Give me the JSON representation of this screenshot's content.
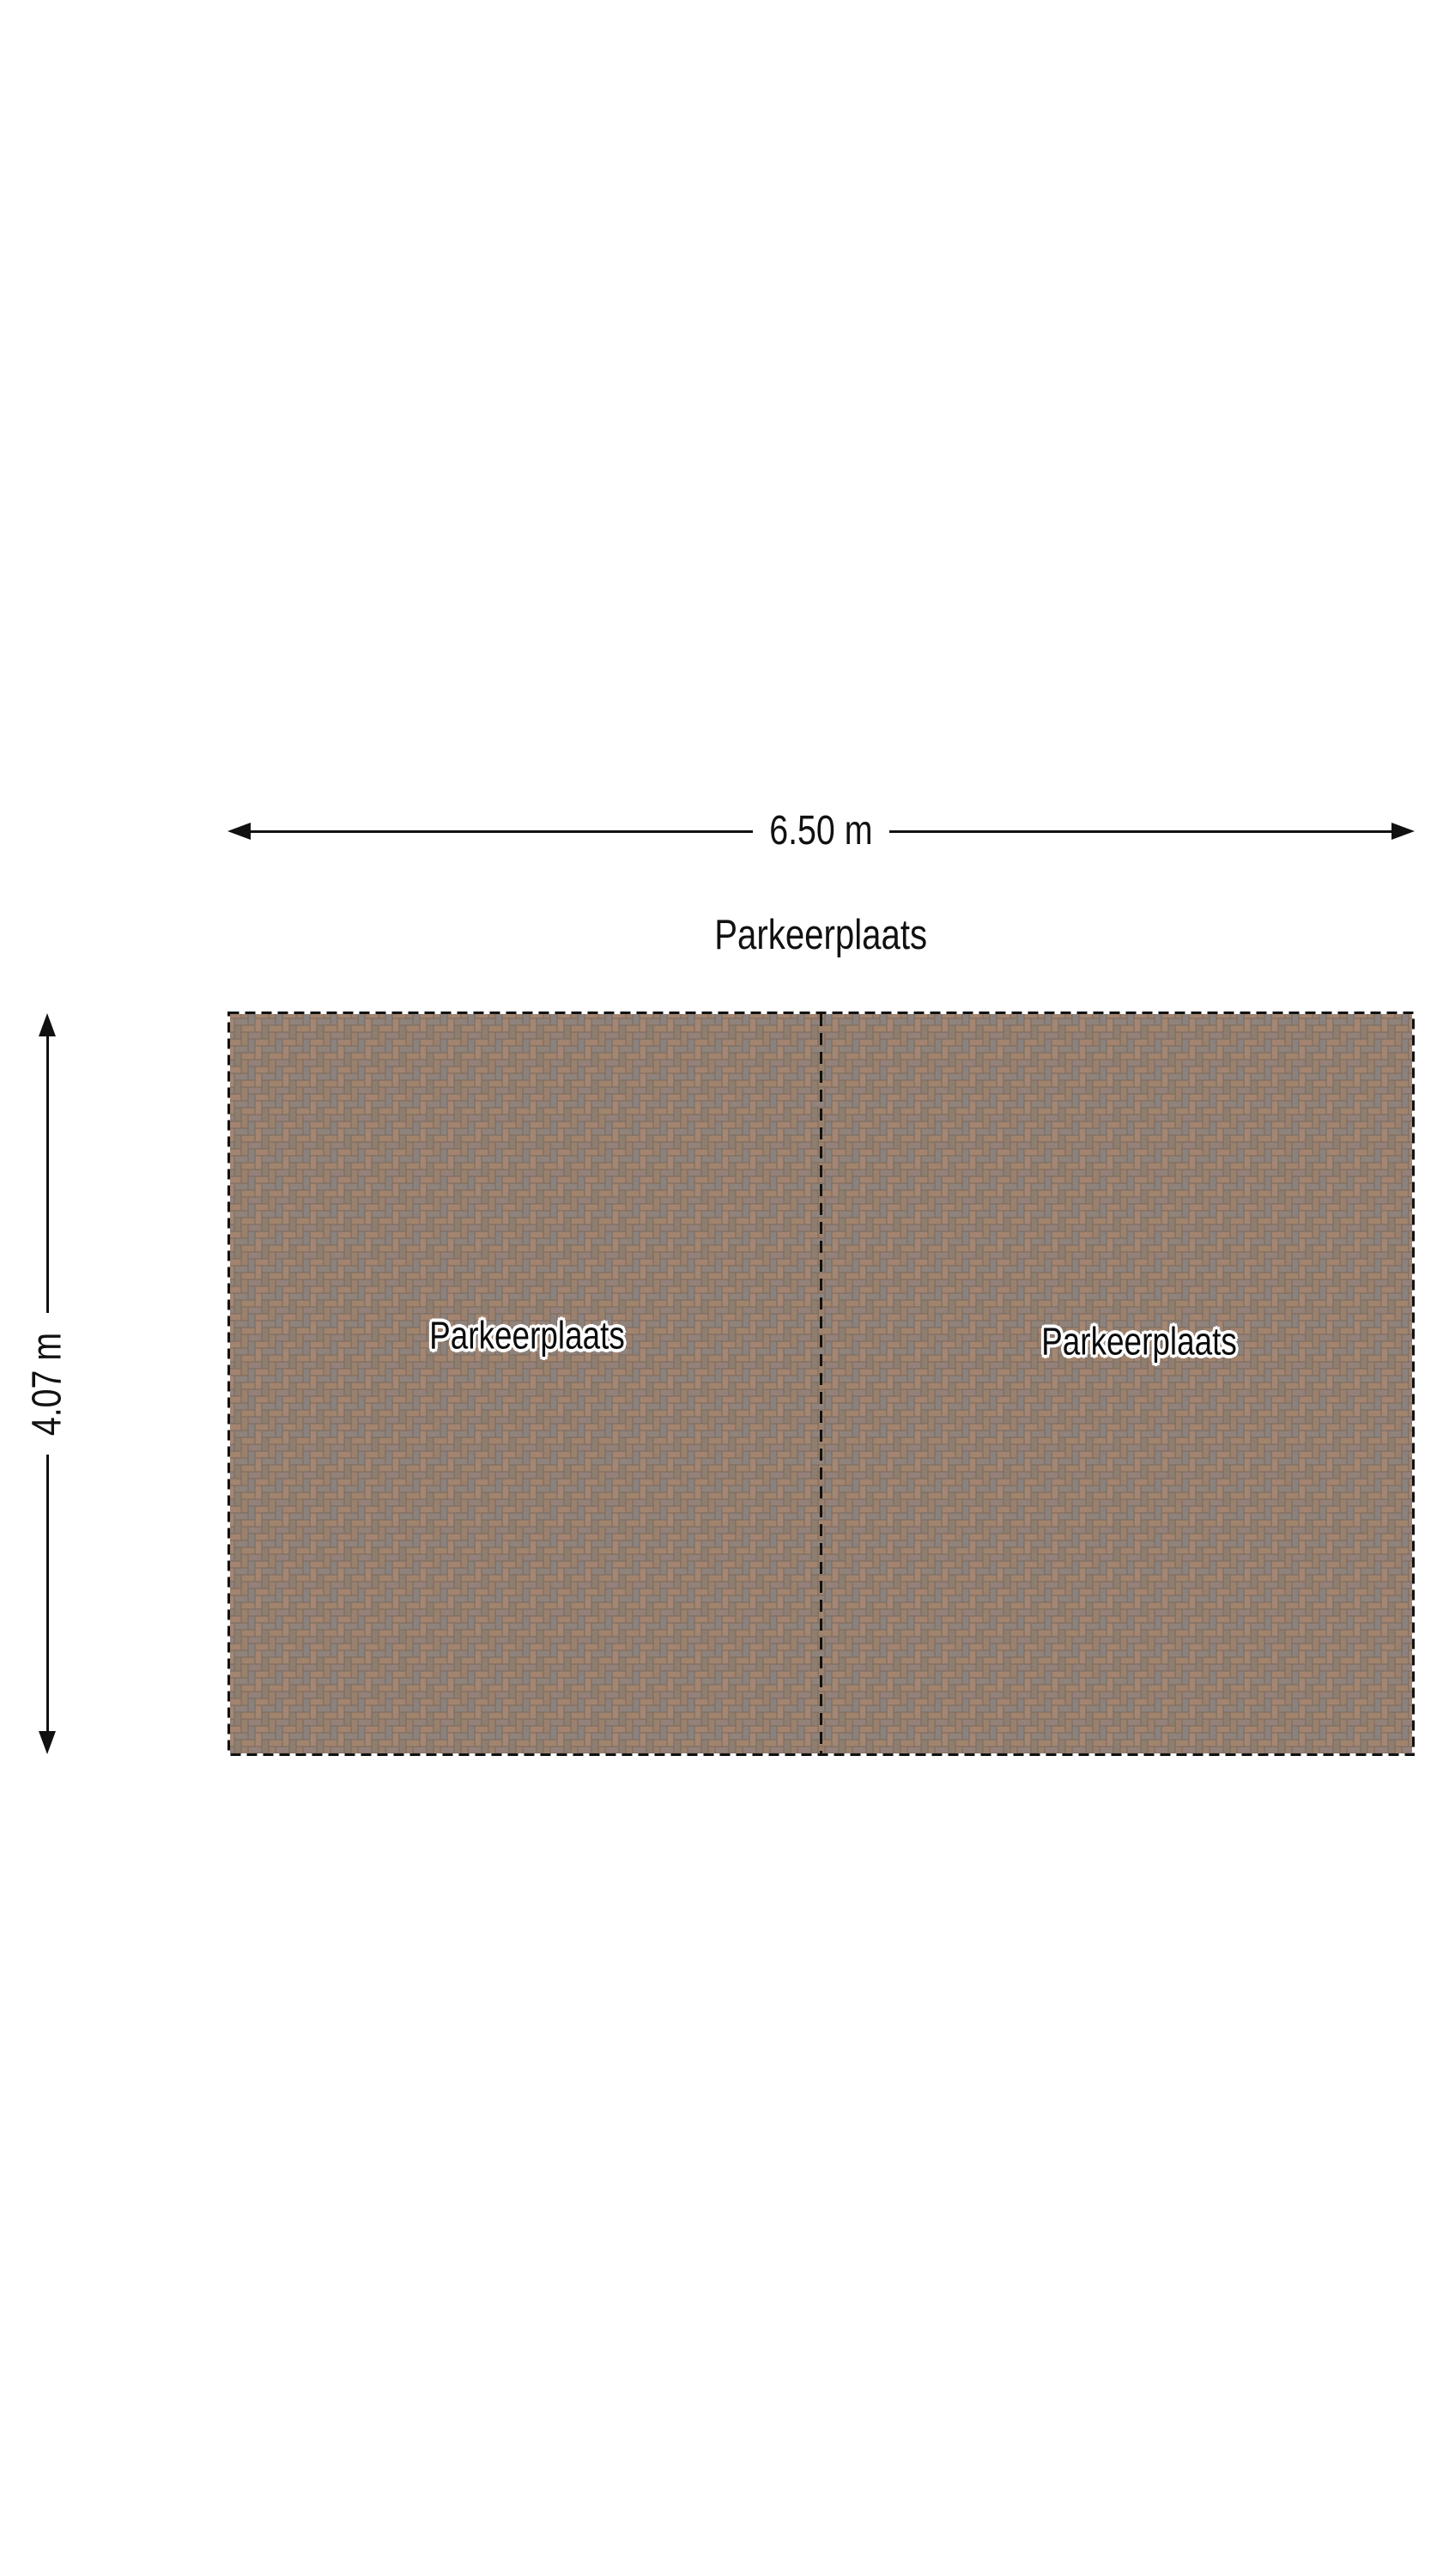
{
  "title": {
    "text": "Parkeerplaats"
  },
  "dimensions": {
    "width": {
      "label": "6.50 m"
    },
    "height": {
      "label": "4.07 m"
    }
  },
  "parking": {
    "spaces": [
      {
        "label": "Parkeerplaats"
      },
      {
        "label": "Parkeerplaats"
      }
    ]
  },
  "icons": {
    "arrow_left": "arrow-left-icon",
    "arrow_right": "arrow-right-icon",
    "arrow_up": "arrow-up-icon",
    "arrow_down": "arrow-down-icon"
  },
  "colors": {
    "background": "#ffffff",
    "outline": "#111111",
    "brick_joint": "#7a695c",
    "brick_tones": [
      "#a28470",
      "#8f837b",
      "#a1846e",
      "#93817a",
      "#9a816e",
      "#8b827e",
      "#a38673",
      "#8e7e70"
    ]
  }
}
